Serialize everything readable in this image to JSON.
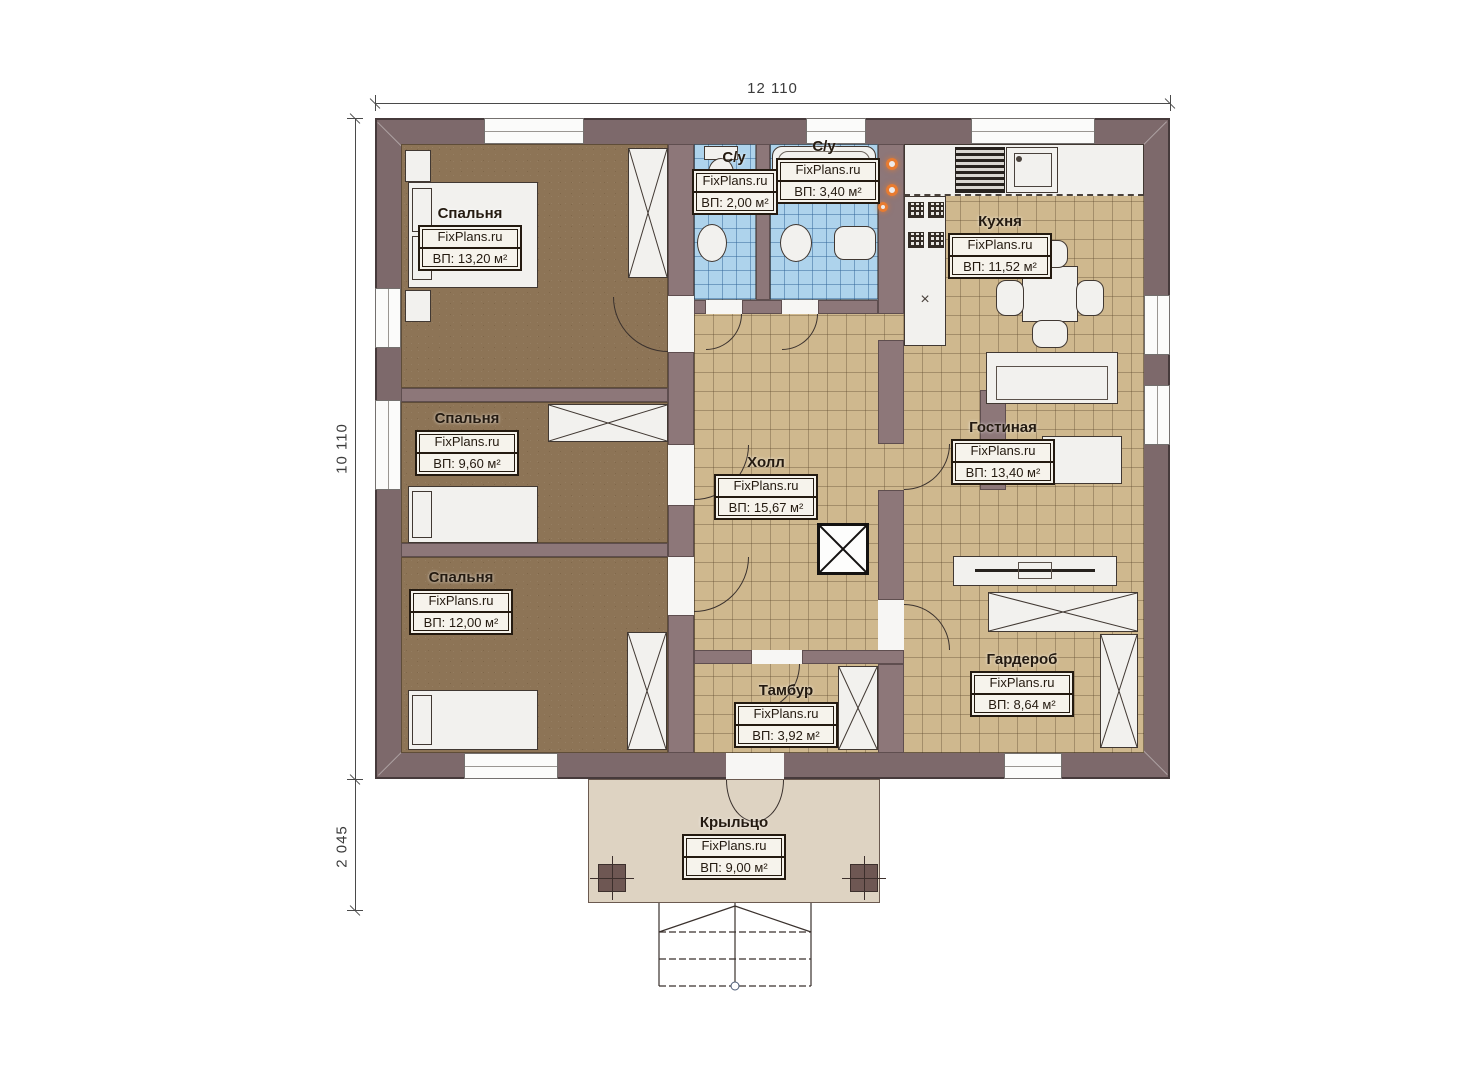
{
  "plan": {
    "brand_watermark": "FixPlans.ru",
    "dimensions": {
      "total_width": "12 110",
      "main_depth": "10 110",
      "porch_depth": "2 045"
    },
    "rooms": {
      "bedroom1": {
        "name": "Спальня",
        "brand": "FixPlans.ru",
        "area": "ВП: 13,20 м²"
      },
      "bedroom2": {
        "name": "Спальня",
        "brand": "FixPlans.ru",
        "area": "ВП: 9,60 м²"
      },
      "bedroom3": {
        "name": "Спальня",
        "brand": "FixPlans.ru",
        "area": "ВП: 12,00 м²"
      },
      "bathroom_small": {
        "name": "С/у",
        "brand": "FixPlans.ru",
        "area": "ВП: 2,00 м²"
      },
      "bathroom_large": {
        "name": "С/у",
        "brand": "FixPlans.ru",
        "area": "ВП: 3,40 м²"
      },
      "kitchen": {
        "name": "Кухня",
        "brand": "FixPlans.ru",
        "area": "ВП: 11,52 м²"
      },
      "hall": {
        "name": "Холл",
        "brand": "FixPlans.ru",
        "area": "ВП: 15,67 м²"
      },
      "living_room": {
        "name": "Гостиная",
        "brand": "FixPlans.ru",
        "area": "ВП: 13,40 м²"
      },
      "wardrobe_room": {
        "name": "Гардероб",
        "brand": "FixPlans.ru",
        "area": "ВП: 8,64 м²"
      },
      "vestibule": {
        "name": "Тамбур",
        "brand": "FixPlans.ru",
        "area": "ВП: 3,92 м²"
      },
      "porch": {
        "name": "Крыльцо",
        "brand": "FixPlans.ru",
        "area": "ВП: 9,00 м²"
      }
    },
    "colors": {
      "wall-outer": "#7d696b",
      "wall-inner": "#8d7779",
      "floor-bedroom": "#8d7456",
      "floor-tile": "#cfb88e",
      "floor-bath": "#aed3ec",
      "porch-floor": "#ded3c2",
      "furniture-fill": "#f2f1ee",
      "accent-orange": "#e87b30"
    }
  }
}
